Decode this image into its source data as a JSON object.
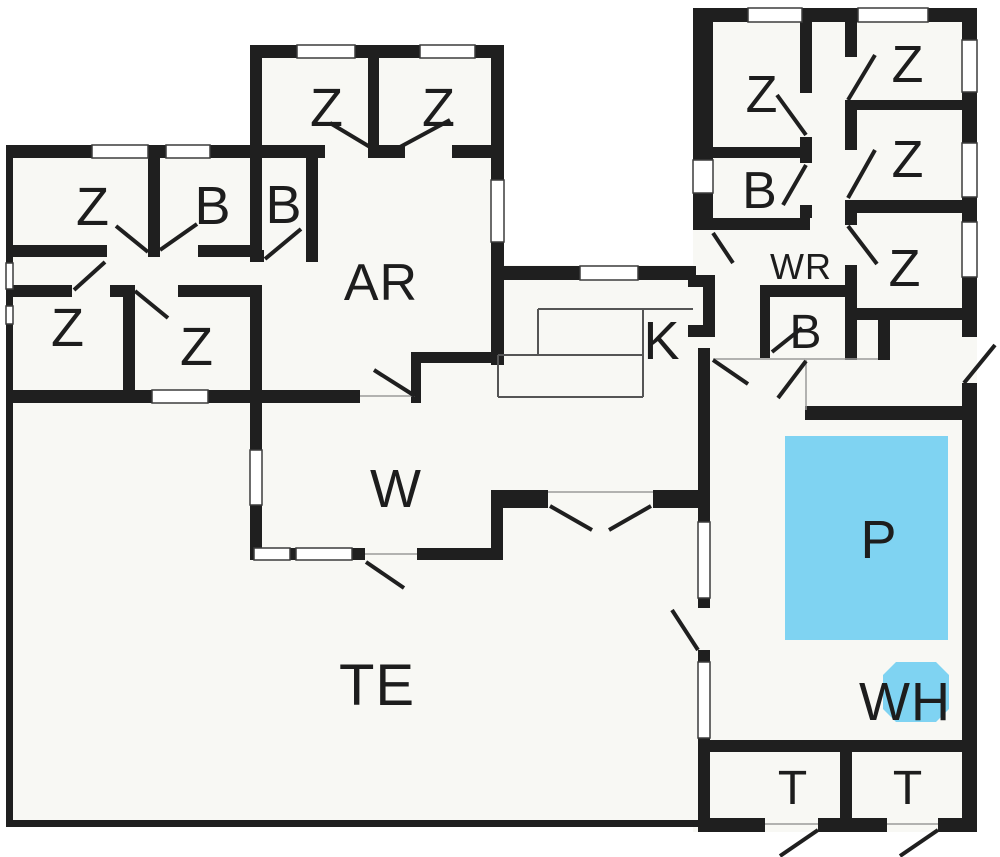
{
  "plan": {
    "name": "holiday-house-floor-plan",
    "rooms": [
      {
        "id": "bedroom-left-nw",
        "label": "Z"
      },
      {
        "id": "bath-left",
        "label": "B"
      },
      {
        "id": "bedroom-left-sw",
        "label": "Z"
      },
      {
        "id": "bedroom-left-south",
        "label": "Z"
      },
      {
        "id": "bedroom-center-left",
        "label": "Z"
      },
      {
        "id": "bedroom-center-right",
        "label": "Z"
      },
      {
        "id": "bath-center",
        "label": "B"
      },
      {
        "id": "living-ar",
        "label": "AR"
      },
      {
        "id": "kitchen",
        "label": "K"
      },
      {
        "id": "living-w",
        "label": "W"
      },
      {
        "id": "terrace",
        "label": "TE"
      },
      {
        "id": "bedroom-right-nw",
        "label": "Z"
      },
      {
        "id": "bath-right",
        "label": "B"
      },
      {
        "id": "corridor-wr",
        "label": "WR"
      },
      {
        "id": "bedroom-east-1",
        "label": "Z"
      },
      {
        "id": "bedroom-east-2",
        "label": "Z"
      },
      {
        "id": "bedroom-east-3",
        "label": "Z"
      },
      {
        "id": "bath-pool",
        "label": "B"
      },
      {
        "id": "pool",
        "label": "P"
      },
      {
        "id": "whirlpool",
        "label": "WH"
      },
      {
        "id": "toilet-left",
        "label": "T"
      },
      {
        "id": "toilet-right",
        "label": "T"
      }
    ]
  },
  "palette": {
    "wall": "#1f1f1f",
    "floor": "#f8f8f4",
    "water": "#7fd3f2",
    "label": "#1d1d1d",
    "frame": "#3c3c3c",
    "sill": "#9a9a9a",
    "counter": "#555555",
    "outside": "#ffffff"
  }
}
